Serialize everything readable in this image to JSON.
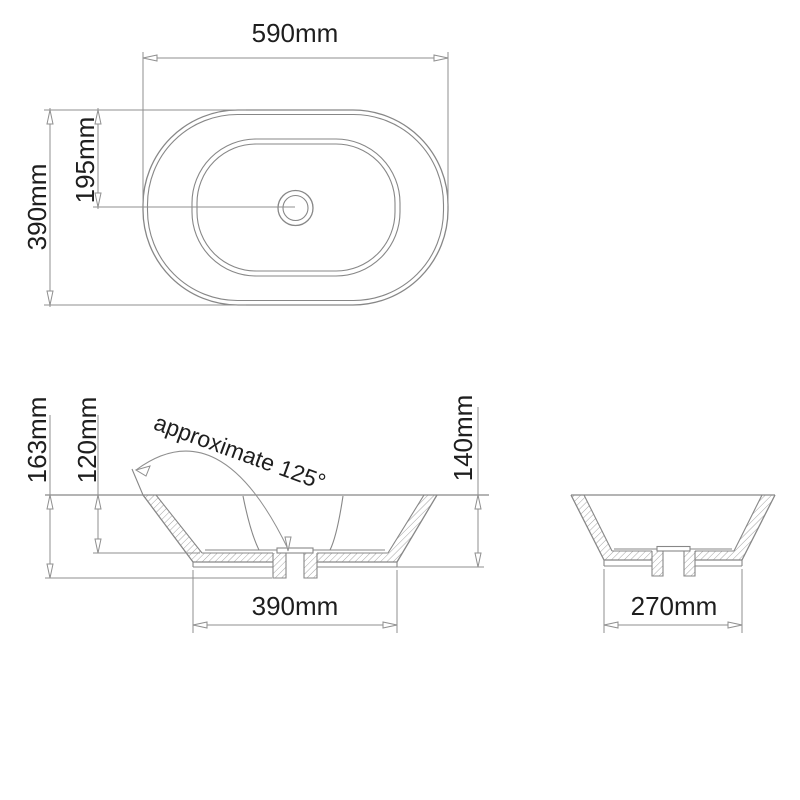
{
  "views": {
    "top": {
      "width_label": "590mm",
      "length_label": "390mm",
      "center_offset_label": "195mm"
    },
    "front": {
      "overall_height_label": "163mm",
      "bowl_depth_label": "120mm",
      "body_height_label": "140mm",
      "base_width_label": "390mm",
      "wall_angle_label": "approximate 125°"
    },
    "side": {
      "base_width_label": "270mm"
    }
  },
  "colors": {
    "line": "#878787",
    "dimline": "#8f8f8f",
    "text": "#1e1e1e",
    "hatch": "#9a9a9a",
    "background": "#ffffff"
  }
}
